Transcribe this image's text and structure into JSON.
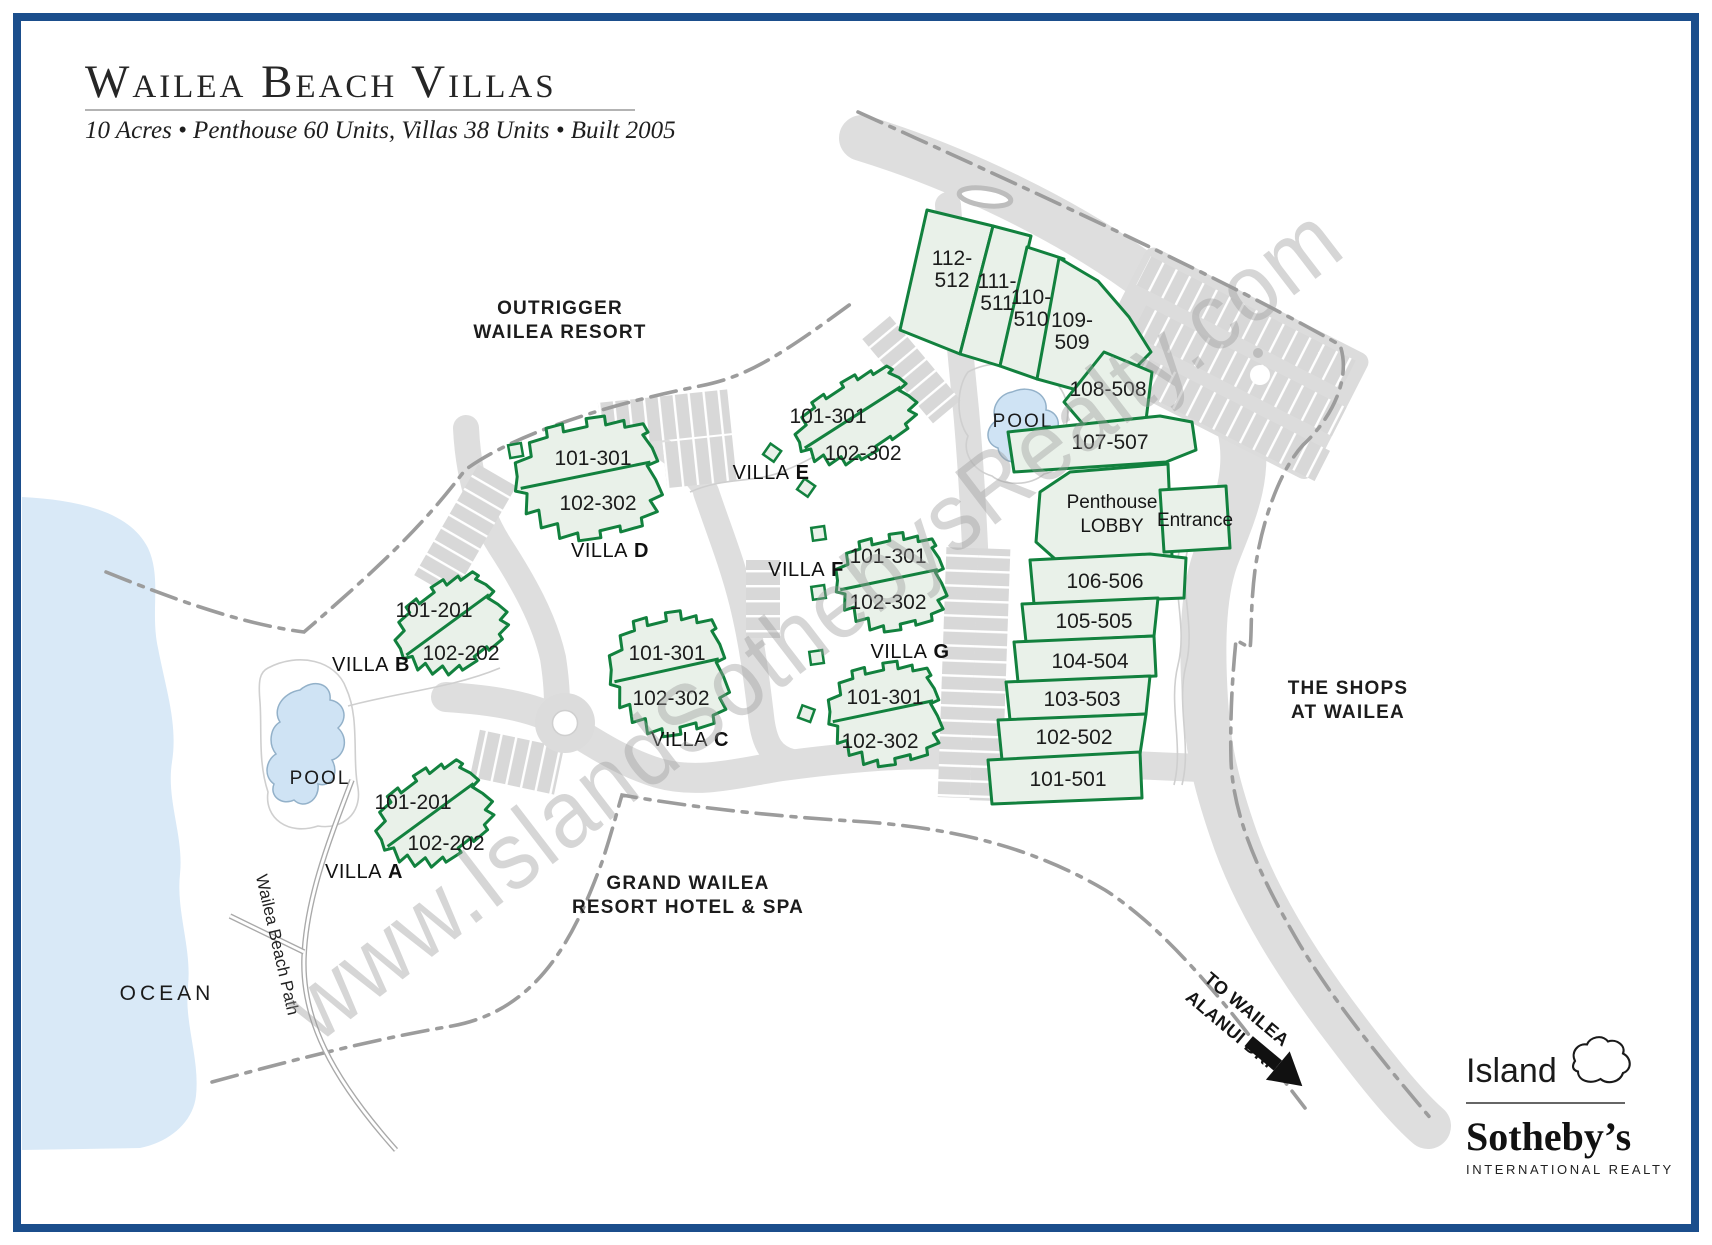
{
  "header": {
    "title": "Wailea Beach Villas",
    "subtitle": "10 Acres • Penthouse 60 Units, Villas 38 Units • Built 2005"
  },
  "map": {
    "areas": {
      "outrigger_l1": "OUTRIGGER",
      "outrigger_l2": "WAILEA RESORT",
      "grand_l1": "GRAND WAILEA",
      "grand_l2": "RESORT HOTEL & SPA",
      "shops_l1": "THE SHOPS",
      "shops_l2": "AT WAILEA",
      "ocean": "OCEAN",
      "beach_path": "Wailea Beach Path",
      "to_wailea_l1": "TO WAILEA",
      "to_wailea_l2": "ALANUI DR."
    },
    "pools": {
      "upper": "POOL",
      "lower": "POOL"
    },
    "villas": [
      {
        "name": "VILLA",
        "letter": "A",
        "unit1": "101-201",
        "unit2": "102-202"
      },
      {
        "name": "VILLA",
        "letter": "B",
        "unit1": "101-201",
        "unit2": "102-202"
      },
      {
        "name": "VILLA",
        "letter": "C",
        "unit1": "101-301",
        "unit2": "102-302"
      },
      {
        "name": "VILLA",
        "letter": "D",
        "unit1": "101-301",
        "unit2": "102-302"
      },
      {
        "name": "VILLA",
        "letter": "E",
        "unit1": "101-301",
        "unit2": "102-302"
      },
      {
        "name": "VILLA",
        "letter": "F",
        "unit1": "101-301",
        "unit2": "102-302"
      },
      {
        "name": "VILLA",
        "letter": "G",
        "unit1": "101-301",
        "unit2": "102-302"
      }
    ],
    "penthouse": {
      "sections": [
        {
          "l1": "112-",
          "l2": "512"
        },
        {
          "l1": "111-",
          "l2": "511"
        },
        {
          "l1": "110-",
          "l2": "510"
        },
        {
          "l1": "109-",
          "l2": "509"
        },
        {
          "l1": "108-508"
        },
        {
          "l1": "107-507"
        },
        {
          "l1": "106-506"
        },
        {
          "l1": "105-505"
        },
        {
          "l1": "104-504"
        },
        {
          "l1": "103-503"
        },
        {
          "l1": "102-502"
        },
        {
          "l1": "101-501"
        }
      ],
      "lobby_l1": "Penthouse",
      "lobby_l2": "LOBBY",
      "entrance": "Entrance"
    }
  },
  "watermark": "www.IslandSothebysRealty.com",
  "logo": {
    "name": "Island",
    "brand": "Sotheby’s",
    "tagline": "INTERNATIONAL REALTY",
    "maui_icon": "maui-island-outline"
  },
  "colors": {
    "border_navy": "#1b4e8c",
    "building_green": "#12813e",
    "building_fill": "#e9f1e9",
    "road_gray": "#dedede",
    "water_blue": "#d9e9f7",
    "dash_gray": "#9c9c9c",
    "watermark_gray": "#9b9b9b"
  }
}
